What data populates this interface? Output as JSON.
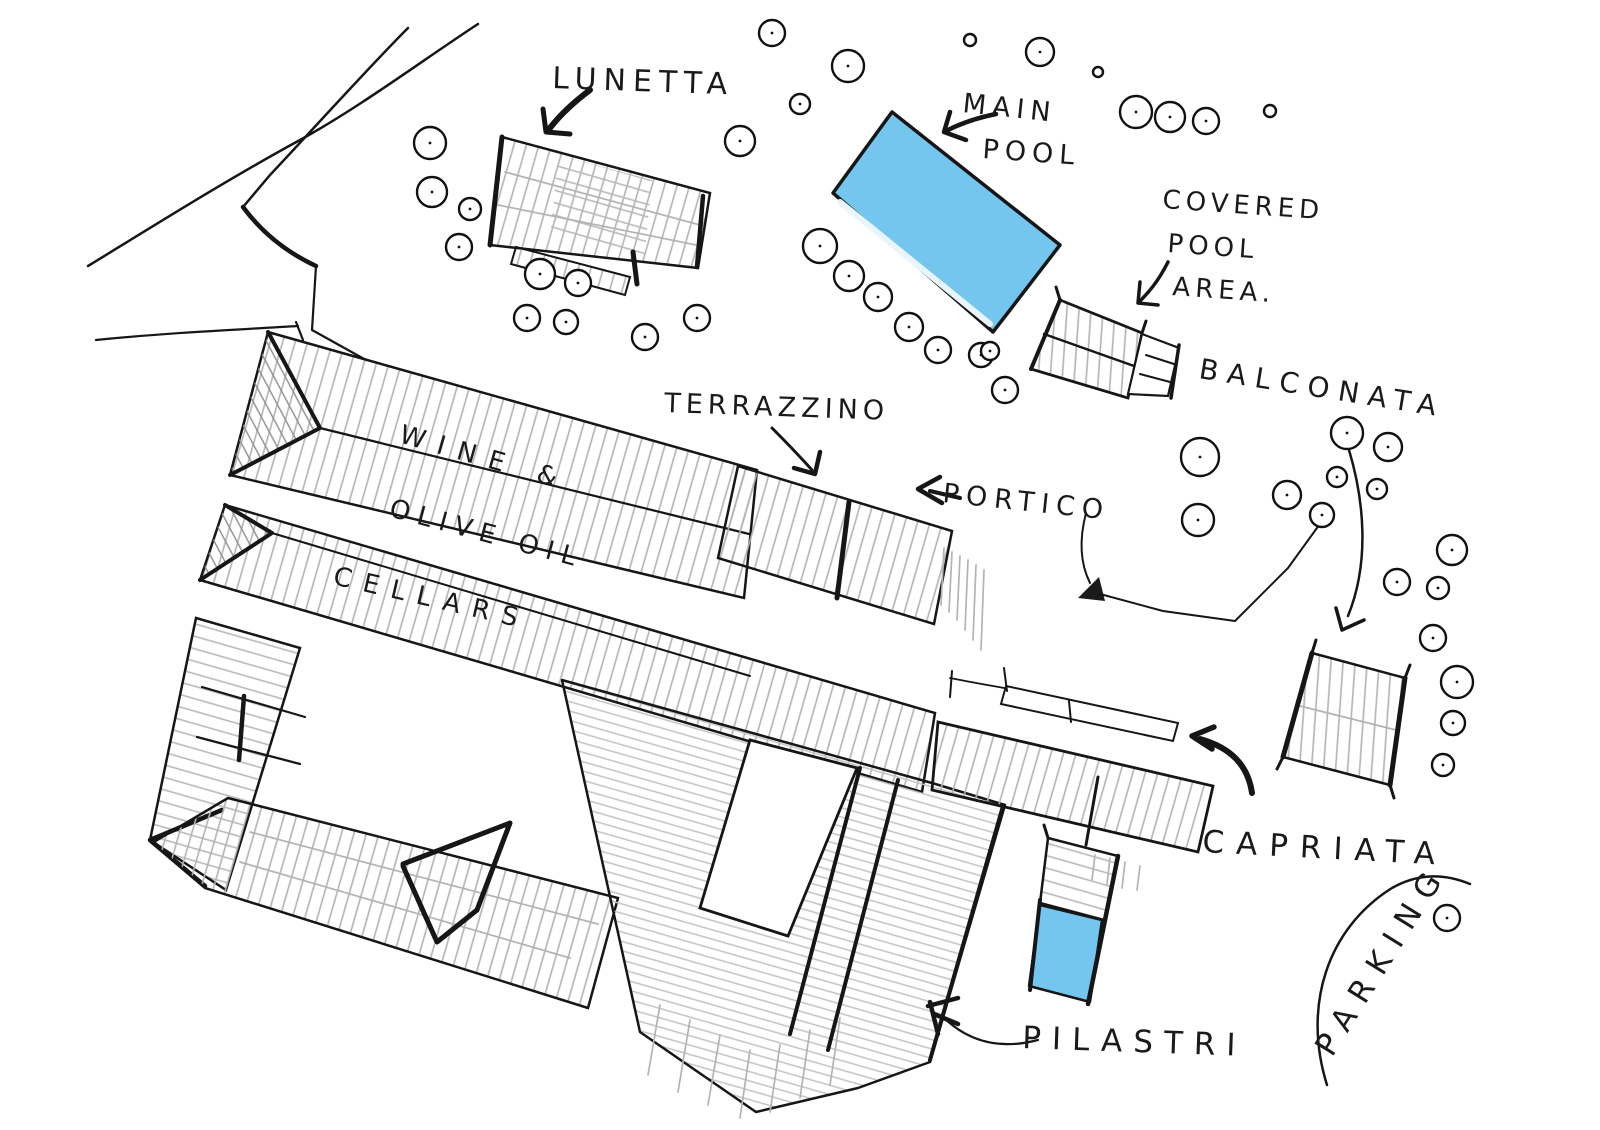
{
  "sketch": {
    "labels": {
      "lunetta": "LUNETTA",
      "main_pool": [
        "MAIN",
        "POOL"
      ],
      "covered_pool": [
        "COVERED",
        "POOL",
        "AREA."
      ],
      "balconata": "BALCONATA",
      "terrazzino": "TERRAZZINO",
      "portico": "PORTICO",
      "cellars": [
        "WINE &",
        "OLIVE OIL",
        "CELLARS"
      ],
      "capriata": "CAPRIATA",
      "pilastri": "PILASTRI",
      "parking": "PARKING"
    },
    "colors": {
      "ink": "#1a1a1a",
      "hatch_gray": "#b3b3b3",
      "pool_blue": "#74c6ef",
      "paper": "#ffffff"
    }
  }
}
